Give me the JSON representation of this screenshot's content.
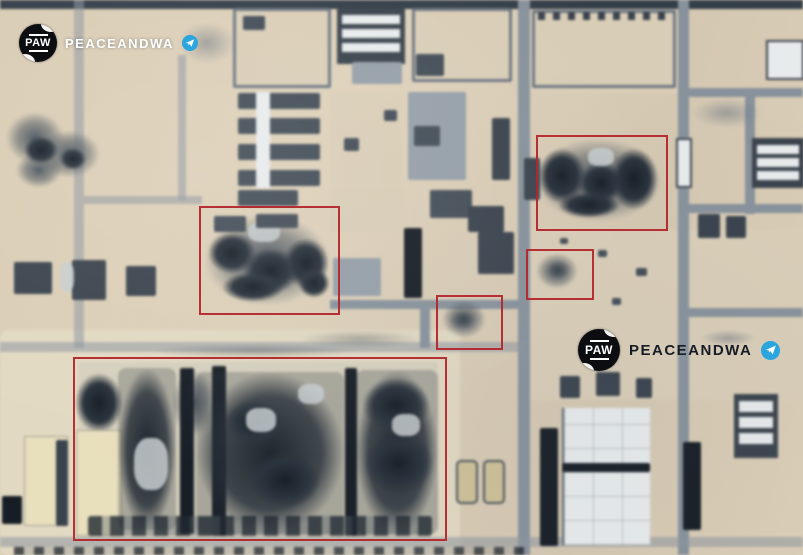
{
  "scene": {
    "kind": "satellite-aerial-photo",
    "subject": "industrial facility with bomb-damage annotation boxes"
  },
  "colors": {
    "annotation_red": "#b3262c",
    "telegram_blue": "#2aa5dd",
    "sand": "#d9ccb4",
    "road_gray": "#87929d",
    "burn_dark": "#141c26",
    "watermark_light": "#ffffff",
    "watermark_dark": "#161c26"
  },
  "watermarks": [
    {
      "id": "top-left",
      "logo_text": "PAW",
      "brand_text": "PEACEANDWA",
      "platform_icon": "telegram-icon",
      "text_color": "#ffffff"
    },
    {
      "id": "center-right",
      "logo_text": "PAW",
      "brand_text": "PEACEANDWA",
      "platform_icon": "telegram-icon",
      "text_color": "#161c26"
    }
  ],
  "annotations": {
    "box_color": "#b3262c",
    "boxes": [
      {
        "id": "warehouse-complex-southwest",
        "x": 73,
        "y": 357,
        "width": 370,
        "height": 180
      },
      {
        "id": "central-west-site",
        "x": 199,
        "y": 206,
        "width": 137,
        "height": 105
      },
      {
        "id": "northeast-site",
        "x": 536,
        "y": 135,
        "width": 128,
        "height": 92
      },
      {
        "id": "center-small-site",
        "x": 436,
        "y": 295,
        "width": 63,
        "height": 51
      },
      {
        "id": "east-small-site",
        "x": 526,
        "y": 249,
        "width": 64,
        "height": 47
      }
    ]
  }
}
